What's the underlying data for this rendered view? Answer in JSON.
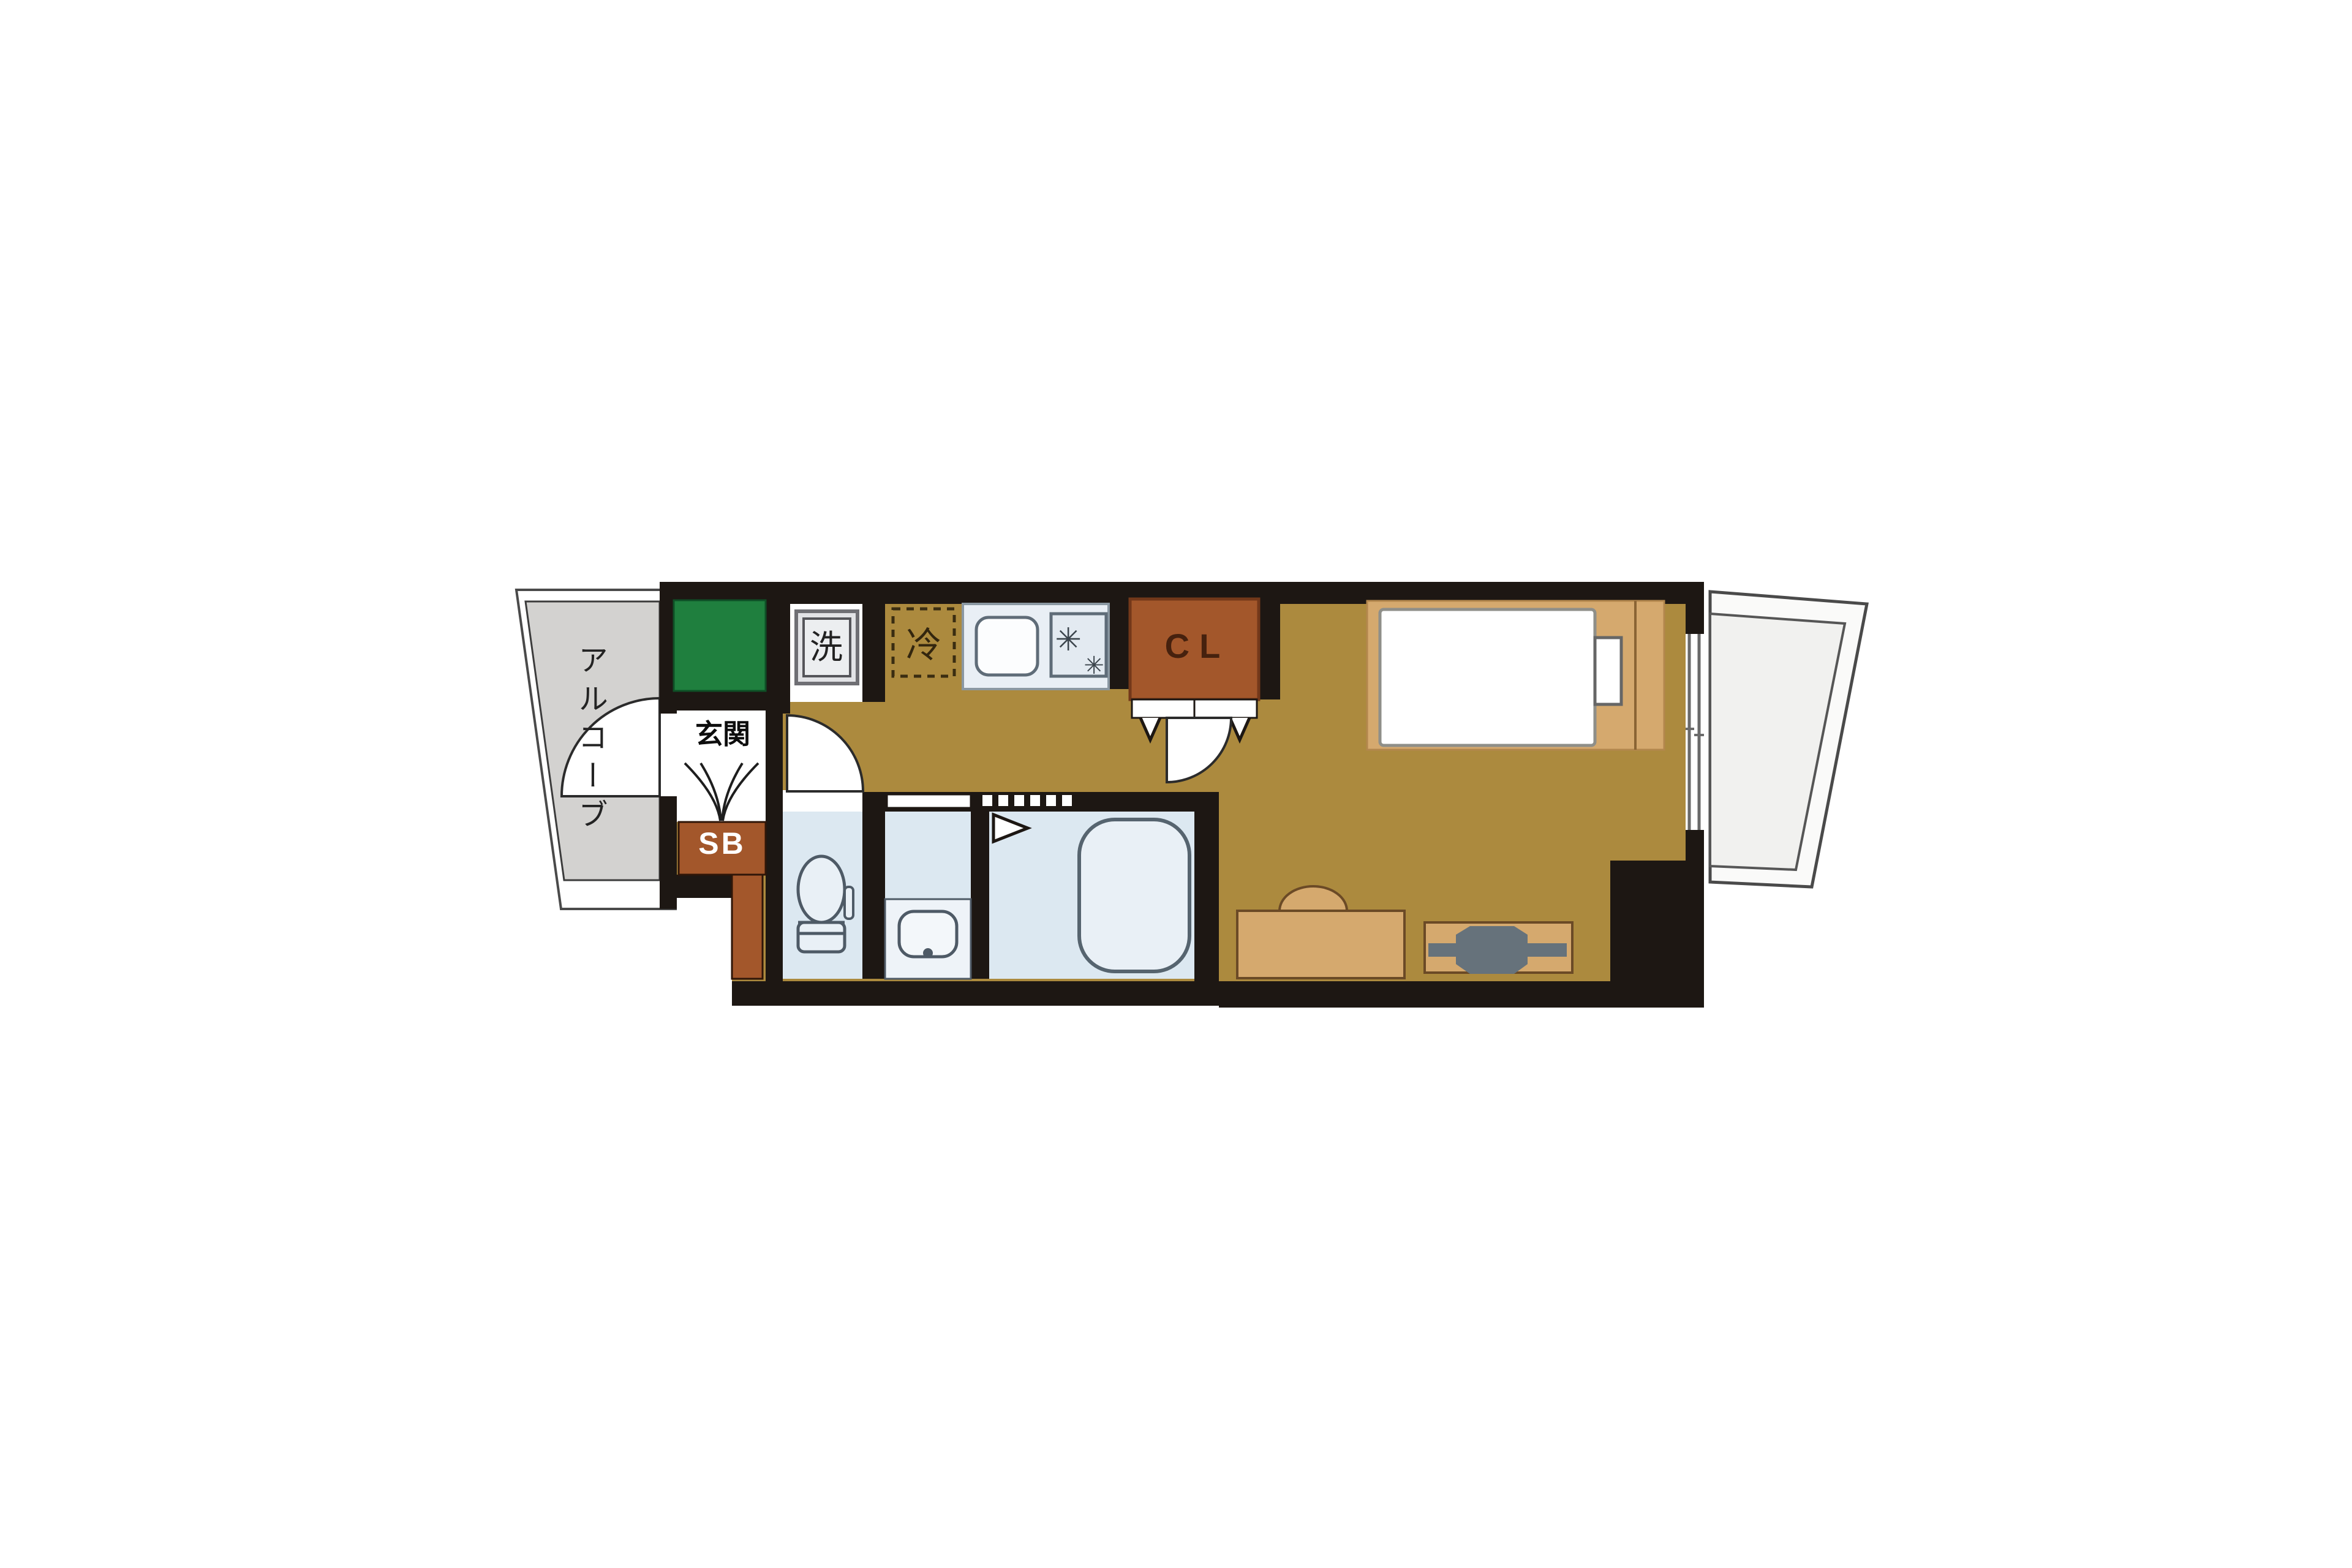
{
  "floor_plan": {
    "labels": {
      "alcove": "アルコーブ",
      "entrance": "玄関",
      "washing_machine": "洗",
      "refrigerator": "冷",
      "closet": "CL",
      "shoe_box": "SB"
    },
    "icons": {
      "stove_burner_glyph": "✳"
    },
    "colors": {
      "wall": "#1d1713",
      "flooring": "#ac8a3e",
      "furniture_tan": "#d5a96e",
      "closet_brown": "#a3572b",
      "green_area": "#1f7f3e",
      "sanitary_blue": "#dce8f1",
      "kitchen_counter": "#e9eff5",
      "alcove_gray": "#d3d2d0",
      "balcony_gray": "#f1f1ef",
      "tv_gray": "#66727b"
    }
  }
}
